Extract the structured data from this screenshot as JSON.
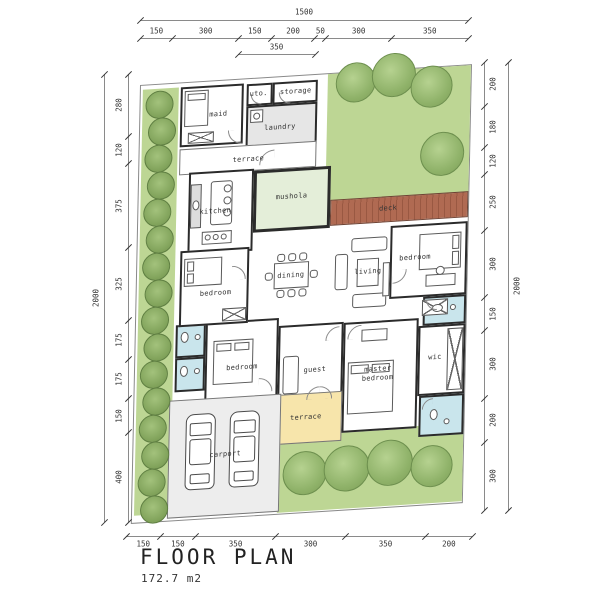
{
  "title": {
    "heading": "FLOOR PLAN",
    "area": "172.7 m2"
  },
  "dimensions": {
    "top": {
      "total": "1500",
      "segments": [
        "150",
        "300",
        "150",
        "200",
        "50",
        "300",
        "350"
      ],
      "sub_segment": "350"
    },
    "left": {
      "total": "2000",
      "segments": [
        "280",
        "120",
        "375",
        "325",
        "175",
        "175",
        "150",
        "400"
      ]
    },
    "right": {
      "total": "2000",
      "segments": [
        "200",
        "180",
        "120",
        "250",
        "300",
        "150",
        "300",
        "200",
        "300"
      ]
    },
    "bottom": {
      "segments": [
        "150",
        "150",
        "350",
        "300",
        "350",
        "200"
      ]
    }
  },
  "rooms": {
    "maid": "maid",
    "utility": "uto.",
    "storage": "storage",
    "laundry": "laundry",
    "terrace_top": "terrace",
    "kitchen": "kitchen",
    "mushola": "mushola",
    "deck": "deck",
    "bedroom_right": "bedroom",
    "dining": "dining",
    "living": "living",
    "bedroom_left": "bedroom",
    "bedroom_center": "bedroom",
    "guest": "guest",
    "wic": "wic",
    "master_bedroom": "master bedroom",
    "terrace_bottom": "terrace",
    "carport": "carport"
  },
  "colors": {
    "lawn": "#bdd694",
    "tree": "#8fb269",
    "deck": "#a96049",
    "mushola": "#e4eed9",
    "bathroom": "#c9e5ec",
    "terrace": "#f7e5ab",
    "laundry": "#e6e6e6",
    "carport": "#ededed",
    "wall": "#2b2b2b"
  },
  "landscape": {
    "hedge_count": 16,
    "trees_top_right": 4,
    "trees_bottom": 4,
    "cars_in_carport": 2
  }
}
